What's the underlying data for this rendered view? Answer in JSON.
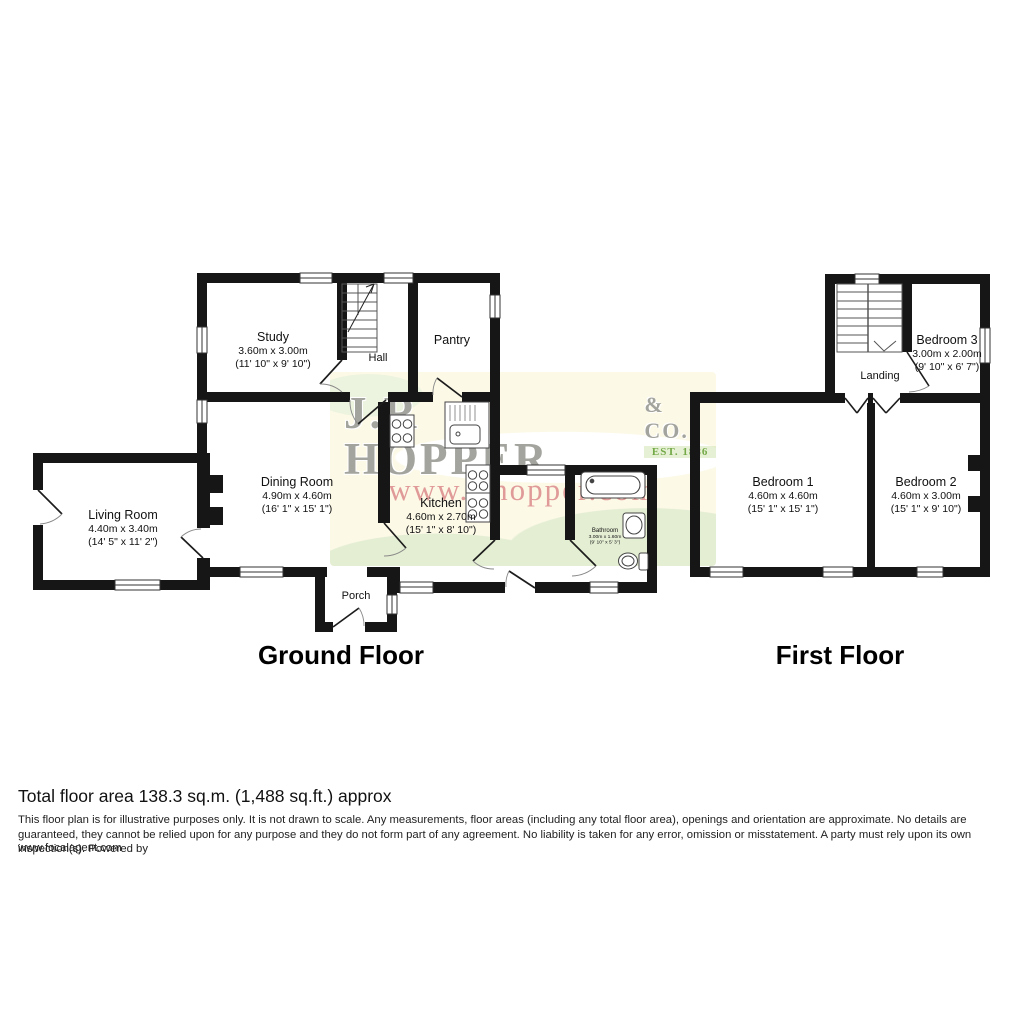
{
  "watermark": {
    "brand": "J.R HOPPER",
    "suffix": "& CO.",
    "established": "EST. 1886",
    "url": "www.jrhopper.com"
  },
  "ground_floor": {
    "label": "Ground Floor",
    "rooms": [
      {
        "id": "study",
        "name": "Study",
        "metric": "3.60m x 3.00m",
        "imperial": "(11' 10\" x 9' 10\")"
      },
      {
        "id": "hall",
        "name": "Hall",
        "metric": "",
        "imperial": ""
      },
      {
        "id": "pantry",
        "name": "Pantry",
        "metric": "",
        "imperial": ""
      },
      {
        "id": "dining",
        "name": "Dining Room",
        "metric": "4.90m x 4.60m",
        "imperial": "(16' 1\" x 15' 1\")"
      },
      {
        "id": "living",
        "name": "Living Room",
        "metric": "4.40m x 3.40m",
        "imperial": "(14' 5\" x 11' 2\")"
      },
      {
        "id": "kitchen",
        "name": "Kitchen",
        "metric": "4.60m x 2.70m",
        "imperial": "(15' 1\" x 8' 10\")"
      },
      {
        "id": "bathroom",
        "name": "Bathroom",
        "metric": "3.00m x 1.60m",
        "imperial": "(9' 10\" x 5' 3\")"
      },
      {
        "id": "porch",
        "name": "Porch",
        "metric": "",
        "imperial": ""
      }
    ]
  },
  "first_floor": {
    "label": "First Floor",
    "rooms": [
      {
        "id": "bedroom1",
        "name": "Bedroom 1",
        "metric": "4.60m x 4.60m",
        "imperial": "(15' 1\" x 15' 1\")"
      },
      {
        "id": "bedroom2",
        "name": "Bedroom 2",
        "metric": "4.60m x 3.00m",
        "imperial": "(15' 1\" x 9' 10\")"
      },
      {
        "id": "bedroom3",
        "name": "Bedroom 3",
        "metric": "3.00m x 2.00m",
        "imperial": "(9' 10\" x 6' 7\")"
      },
      {
        "id": "landing",
        "name": "Landing",
        "metric": "",
        "imperial": ""
      }
    ]
  },
  "footer": {
    "total_area": "Total floor area 138.3 sq.m. (1,488 sq.ft.) approx",
    "disclaimer": "This floor plan is for illustrative purposes only. It is not drawn to scale. Any measurements, floor areas (including any total floor area), openings and orientation are approximate. No details are guaranteed, they cannot be relied upon for any purpose and they do not form part of any agreement. No liability is taken for any error, omission or misstatement. A party must rely upon its own inspection(s). Powered by",
    "agent_url": "www.focalagent.com"
  },
  "colors": {
    "wall": "#161616",
    "watermark_pink": "#dd8f8f",
    "watermark_gray": "#94948e",
    "watermark_green": "#74a948",
    "band_cream": "#fcf9e7",
    "band_green": "#e4eed3"
  }
}
